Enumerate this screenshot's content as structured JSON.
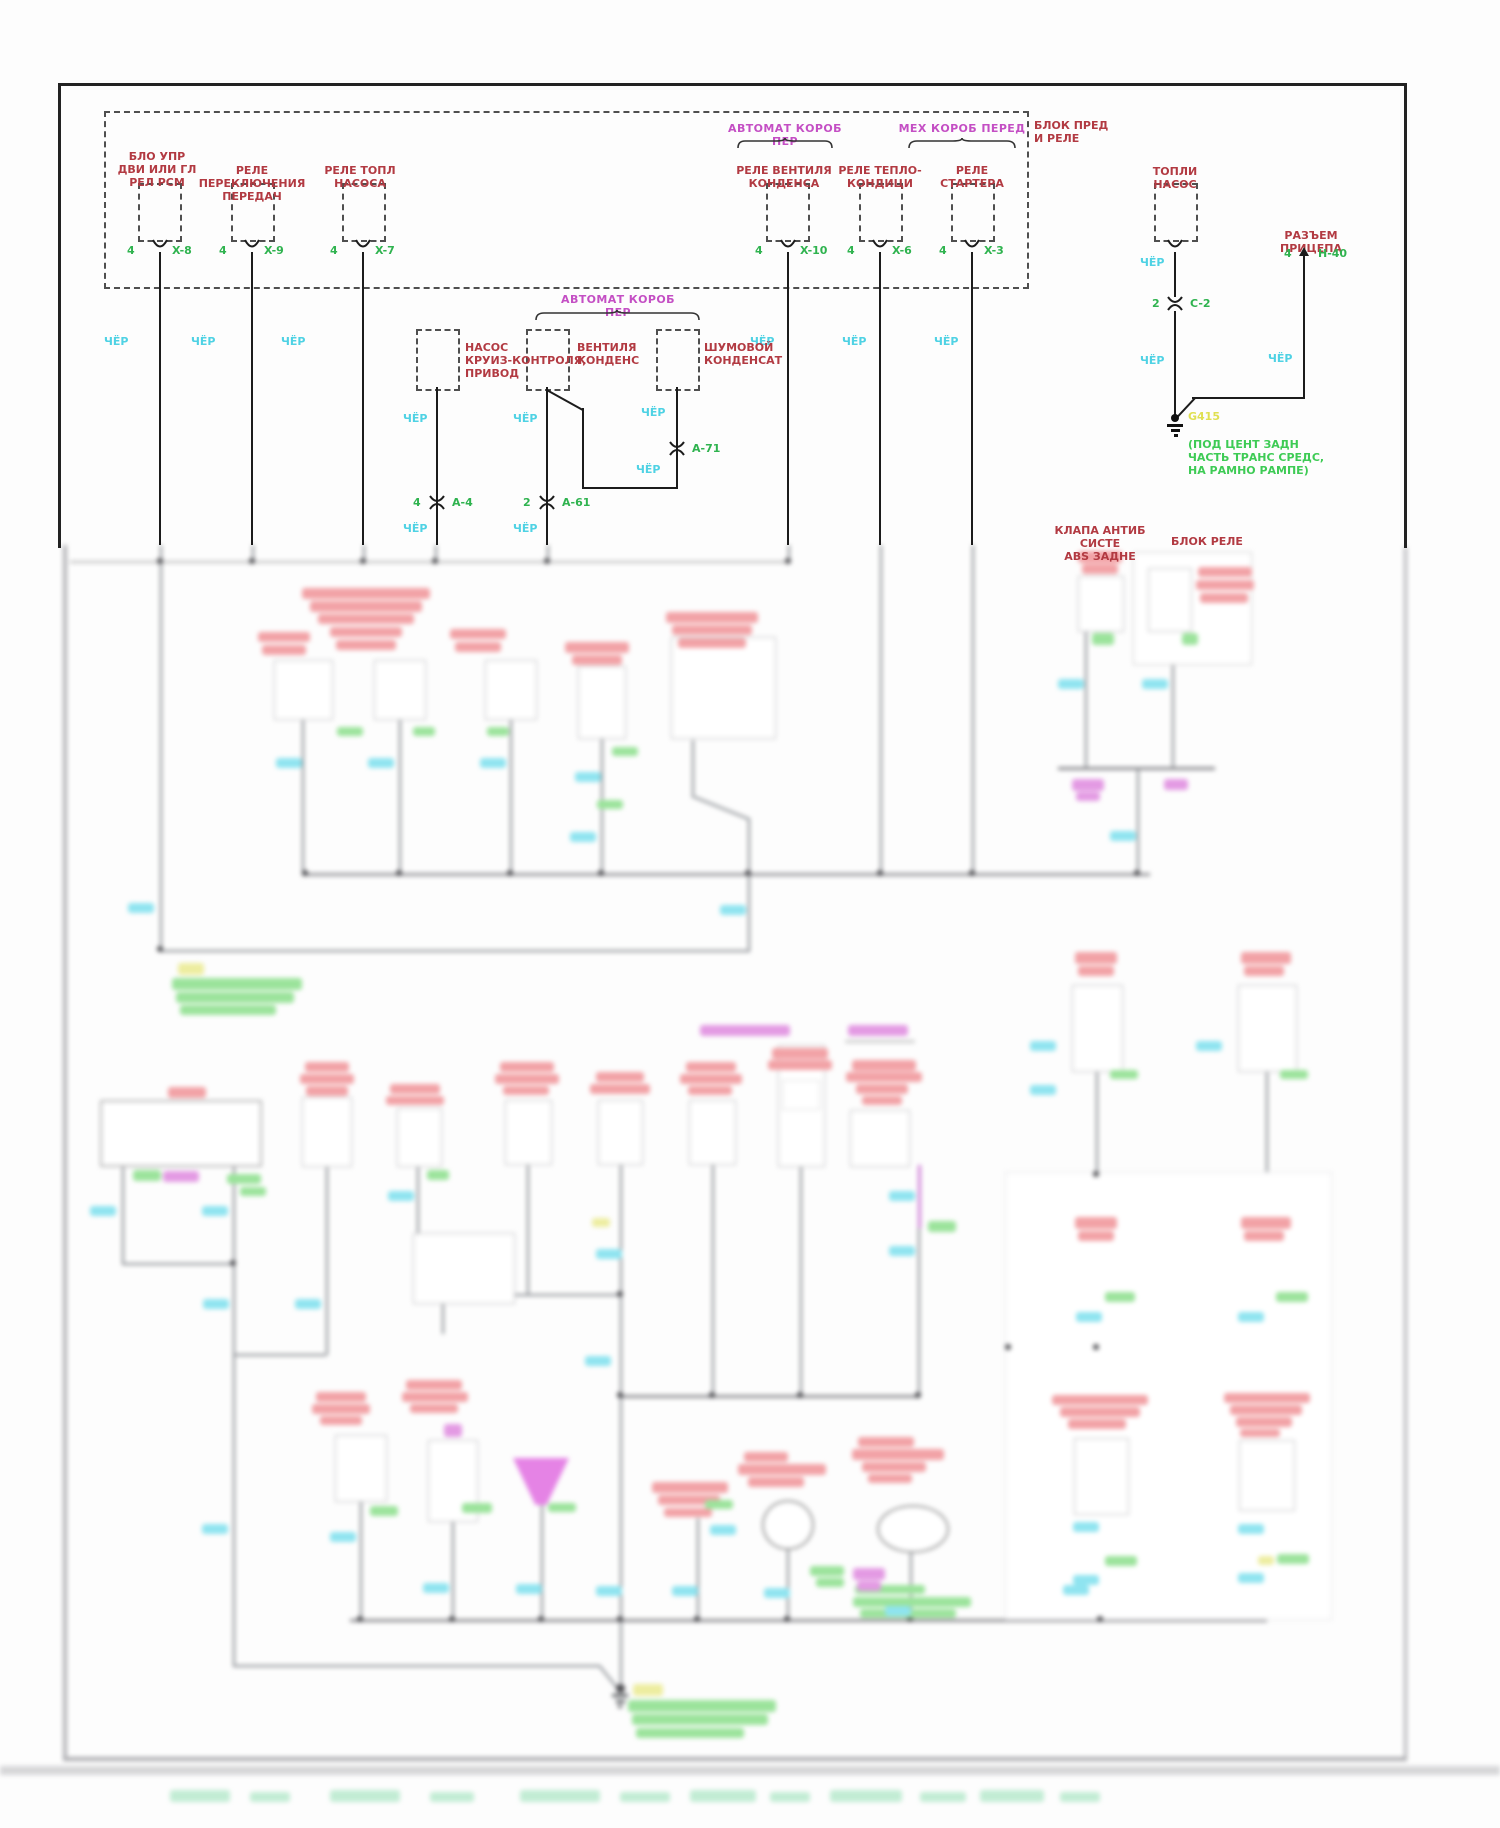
{
  "diagram_title_block": {
    "line1": "БЛОК ПРЕД",
    "line2": "И РЕЛЕ"
  },
  "fuse_block": {
    "c1": {
      "l1": "БЛО УПР",
      "l2": "ДВИ ИЛИ ГЛ",
      "l3": "РЕЛ РСМ",
      "pin": "4",
      "conn": "X-8"
    },
    "c2": {
      "l1": "РЕЛЕ ПЕРЕКЛЮЧЕНИЯ",
      "l2": "ПЕРЕДАЧ",
      "pin": "4",
      "conn": "X-9"
    },
    "c3": {
      "l1": "РЕЛЕ ТОПЛ",
      "l2": "НАСОСА",
      "pin": "4",
      "conn": "X-7"
    },
    "c4": {
      "l1": "РЕЛЕ ВЕНТИЛЯ",
      "l2": "КОНДЕНСА",
      "pin": "4",
      "conn": "X-10"
    },
    "c5": {
      "l1": "РЕЛЕ ТЕПЛО-",
      "l2": "КОНДИЦИ",
      "pin": "4",
      "conn": "X-6"
    },
    "c6": {
      "l1": "РЕЛЕ",
      "l2": "СТАРТЕРА",
      "pin": "4",
      "conn": "X-3"
    },
    "group_auto": "АВТОМАТ КОРОБ ПЕР",
    "group_manual": "МЕХ КОРОБ ПЕРЕД"
  },
  "mid": {
    "group_auto": "АВТОМАТ КОРОБ ПЕР",
    "m1": {
      "l1": "НАСОС",
      "l2": "КРУИЗ-КОНТРОЛЯ,",
      "l3": "ПРИВОД",
      "pin": "4",
      "conn": "A-4"
    },
    "m2": {
      "l1": "ВЕНТИЛЯ",
      "l2": "КОНДЕНС",
      "pin": "2",
      "conn": "A-61"
    },
    "m3": {
      "l1": "ШУМОВОЙ",
      "l2": "КОНДЕНСАТ",
      "conn": "A-71"
    }
  },
  "fuel_pump": {
    "l1": "ТОПЛИ",
    "l2": "НАСОС",
    "pin": "2",
    "conn": "C-2"
  },
  "trailer": {
    "l1": "РАЗЪЕМ",
    "l2": "ПРИЦЕПА",
    "pin": "4",
    "conn": "H-40"
  },
  "ground": {
    "id": "G415",
    "loc1": "(ПОД ЦЕНТ ЗАДН",
    "loc2": "ЧАСТЬ ТРАНС СРЕДС,",
    "loc3": "НА РАМНО РАМПЕ)"
  },
  "abs_valve": {
    "l1": "КЛАПА АНТИБ",
    "l2": "СИСТЕ",
    "l3": "ABS ЗАДНЕ"
  },
  "relay_block_label": "БЛОК РЕЛЕ",
  "wire": {
    "black": "ЧЁР"
  },
  "colors": {
    "label_red": "#b23a42",
    "group_magenta": "#c44fc4",
    "pin_green": "#2fb34f",
    "wire_cyan": "#4fd2e4",
    "ground_yellow": "#e0e052",
    "ground_green": "#3ecb55"
  }
}
